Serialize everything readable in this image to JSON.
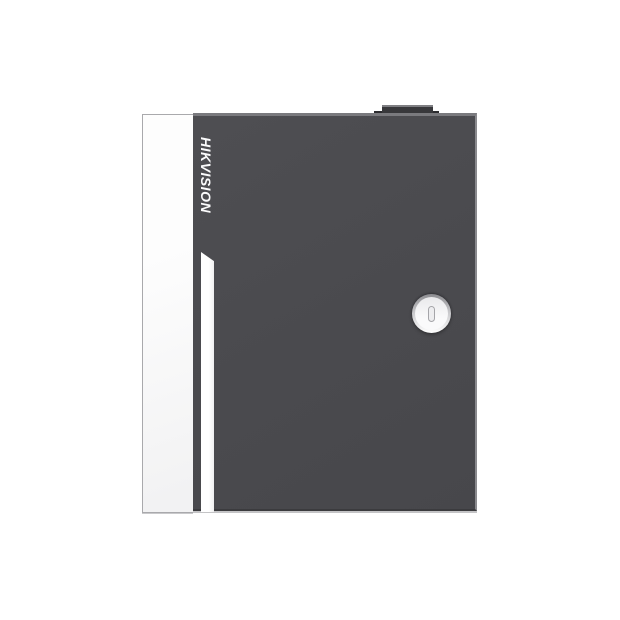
{
  "brand": {
    "label": "HIKVISION"
  },
  "colors": {
    "background": "#ffffff",
    "door": "#4a4a4e",
    "door-top": "#7a7a7e",
    "door-right": "#8a8a8e",
    "door-bottom": "#3b3b3e",
    "panel": "#fdfdfd",
    "panel-border": "#a9a9ac",
    "knob": "#38383b",
    "knob-top": "#7f7f83",
    "knob-tab": "#2c2c2f",
    "stripe": "#ffffff",
    "brand-text": "#fbfbfc",
    "lock-ring-top": "#8c8c90",
    "lock-face": "#fafafb",
    "keyhole-border": "#a5a5a9"
  }
}
